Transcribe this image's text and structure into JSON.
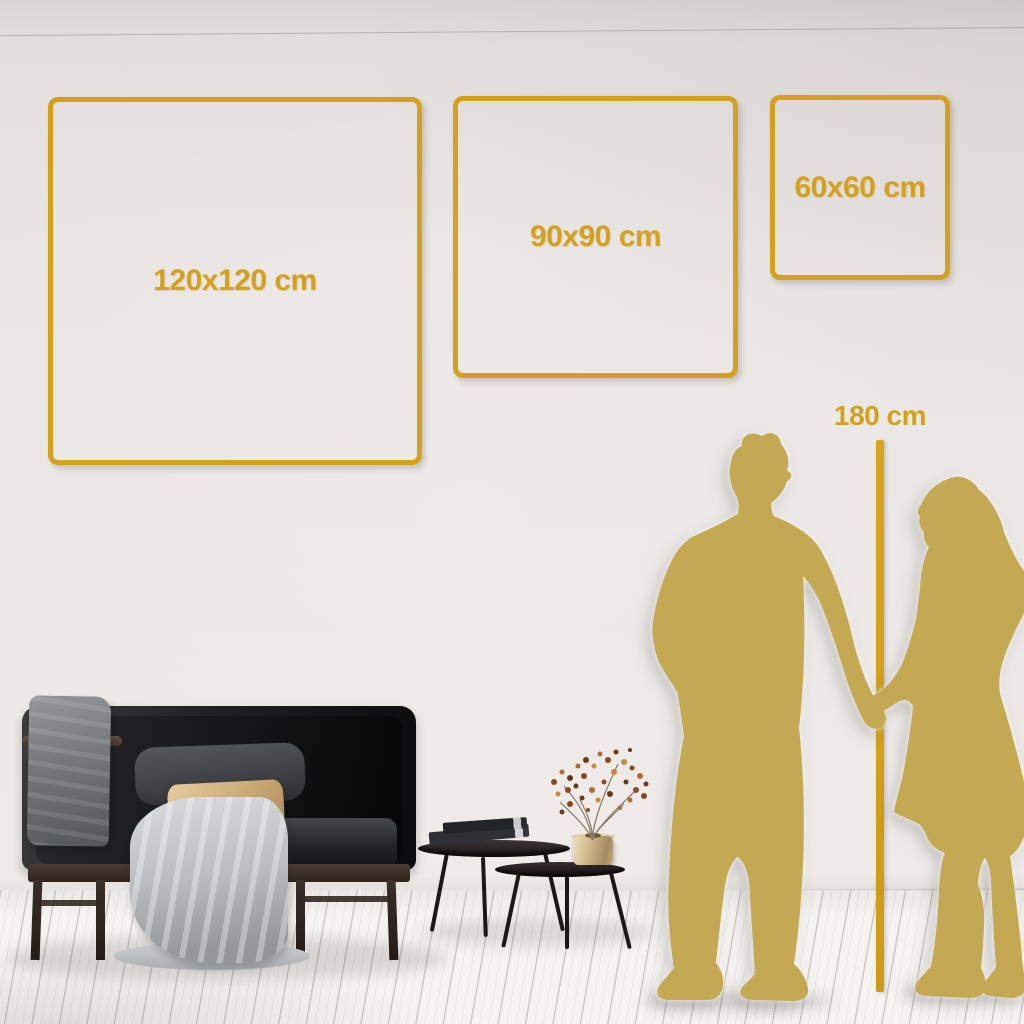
{
  "size_guide": {
    "squares": [
      {
        "label": "120x120 cm"
      },
      {
        "label": "90x90 cm"
      },
      {
        "label": "60x60 cm"
      }
    ],
    "height_marker": {
      "label": "180 cm"
    }
  },
  "scene": {
    "description": "Living room wall mockup with three gold square size outlines, a charcoal sofa with blanket and tan pillow, nesting coffee tables with books and a gold vase with rust-colored sprigs, and a gold couple silhouette holding hands beside a 180 cm height line"
  },
  "palette": {
    "accent_gold": "#d5a01b",
    "silhouette_gold": "#c5a952",
    "wall": "#e9e6e3",
    "floor": "#f5f3f0"
  }
}
